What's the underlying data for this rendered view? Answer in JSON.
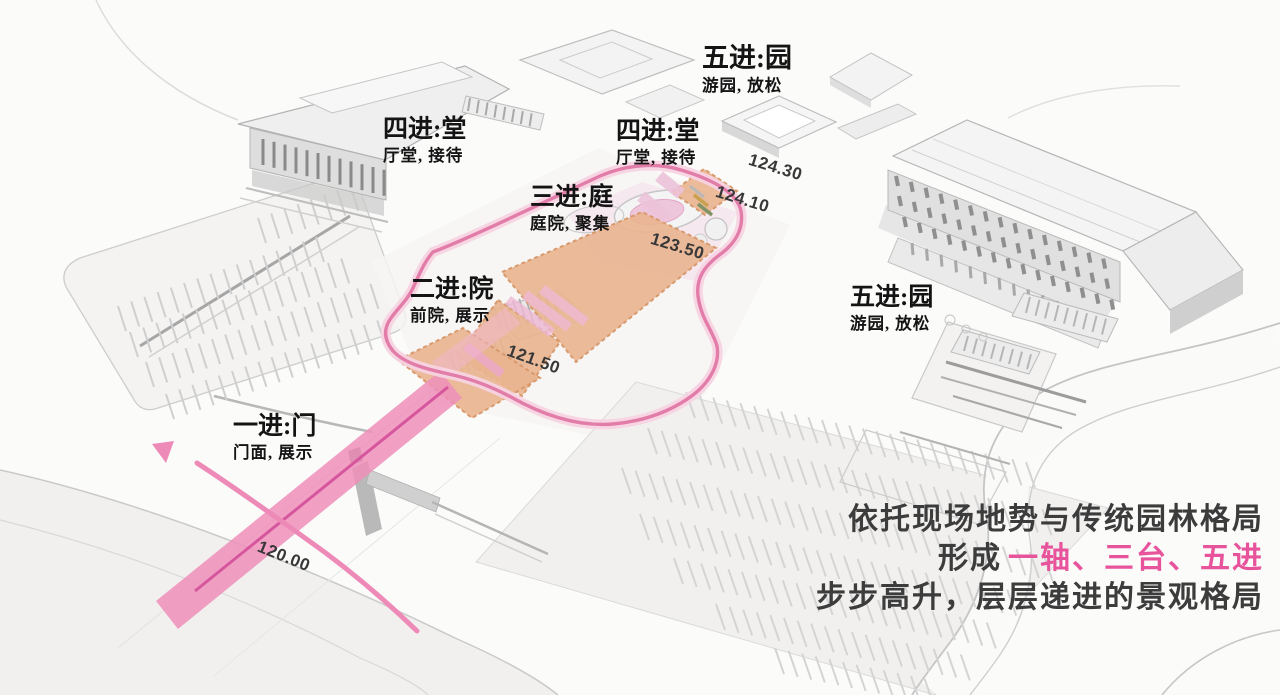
{
  "diagram": {
    "stages": [
      {
        "title": "一进:门",
        "subtitle": "门面, 展示"
      },
      {
        "title": "二进:院",
        "subtitle": "前院, 展示"
      },
      {
        "title": "三进:庭",
        "subtitle": "庭院, 聚集"
      },
      {
        "title": "四进:堂",
        "subtitle": "厅堂, 接待"
      },
      {
        "title": "四进:堂",
        "subtitle": "厅堂, 接待"
      },
      {
        "title": "五进:园",
        "subtitle": "游园, 放松"
      },
      {
        "title": "五进:园",
        "subtitle": "游园, 放松"
      }
    ],
    "elevations": [
      {
        "label": "124.30"
      },
      {
        "label": "124.10"
      },
      {
        "label": "123.50"
      },
      {
        "label": "121.50"
      },
      {
        "label": "120.00"
      }
    ],
    "caption": {
      "line1": "依托现场地势与传统园林格局",
      "line2_prefix": "形成",
      "line2_highlight": "一轴、三台、五进",
      "line3": "步步高升，层层递进的景观格局"
    },
    "colors": {
      "axis_pink": "#e27ca9",
      "road_pink": "#ee8fba",
      "highlight_pink": "#e8549c",
      "terrace_tan": "#e9b48f",
      "text_dark": "#3c3c3c"
    }
  }
}
